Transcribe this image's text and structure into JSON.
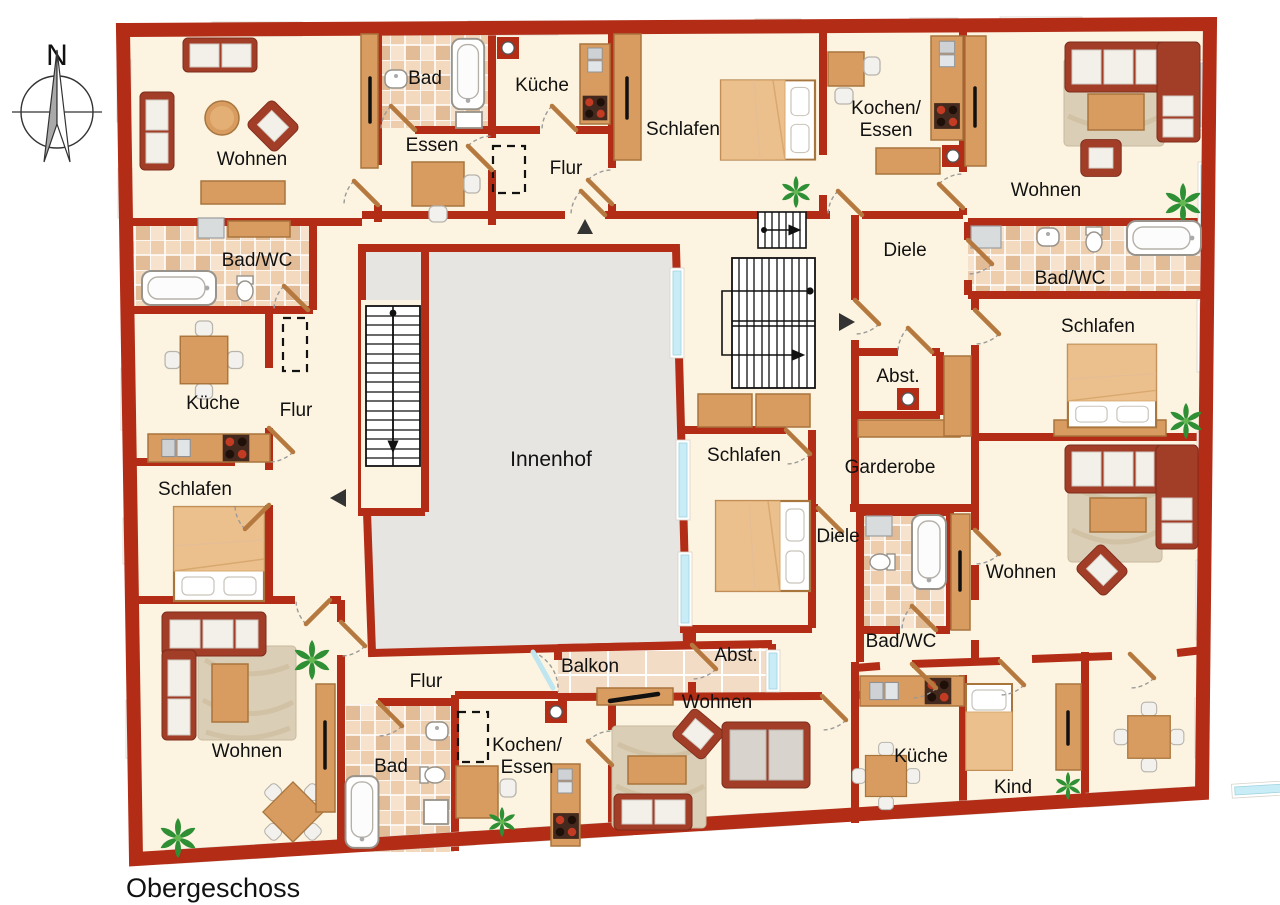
{
  "type": "floorplan",
  "floor_title": "Obergeschoss",
  "compass": {
    "north_label": "N"
  },
  "colors": {
    "wall": "#b22c16",
    "floor": "#fcf4e0",
    "courtyard": "#e6e5e2",
    "window_glass": "#c9edf6",
    "tile_base": "#f7e3cd",
    "wood": "#d99c60",
    "stair_lines": "#111111"
  },
  "labels": {
    "north": "N",
    "title": "Obergeschoss",
    "innenhof": "Innenhof",
    "balkon": "Balkon",
    "wohnen_tl": "Wohnen",
    "bad_top": "Bad",
    "essen_top": "Essen",
    "kueche_top": "Küche",
    "flur_top": "Flur",
    "schlafen_top": "Schlafen",
    "kochen_essen_tr_1": "Kochen/",
    "kochen_essen_tr_2": "Essen",
    "wohnen_tr": "Wohnen",
    "diele_tr": "Diele",
    "badwc_r": "Bad/WC",
    "schlafen_r": "Schlafen",
    "wohnen_br": "Wohnen",
    "badwc_l": "Bad/WC",
    "kueche_l": "Küche",
    "flur_l": "Flur",
    "schlafen_l": "Schlafen",
    "abst_c": "Abst.",
    "garderobe": "Garderobe",
    "schlafen_c": "Schlafen",
    "diele_b": "Diele",
    "badwc_b": "Bad/WC",
    "abst_b": "Abst.",
    "flur_b": "Flur",
    "wohnen_bl": "Wohnen",
    "bad_b": "Bad",
    "kochen_essen_b_1": "Kochen/",
    "kochen_essen_b_2": "Essen",
    "wohnen_bm": "Wohnen",
    "kueche_br": "Küche",
    "kind": "Kind"
  }
}
